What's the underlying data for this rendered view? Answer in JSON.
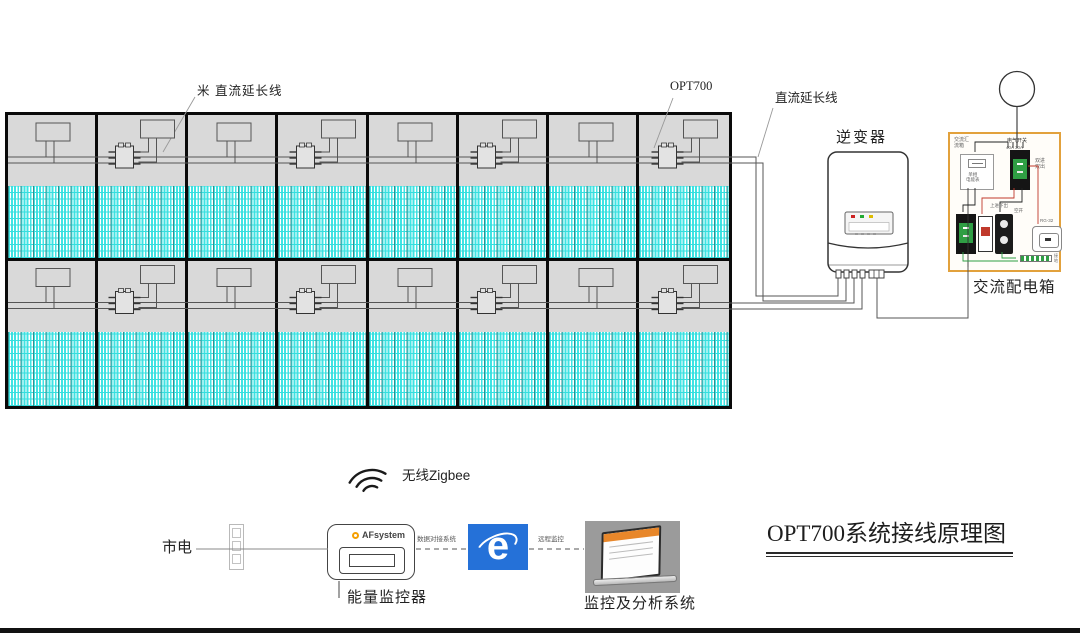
{
  "array": {
    "rows": 2,
    "cols": 8
  },
  "labels": {
    "dc_ext_top": "米  直流延长线",
    "opt700": "OPT700",
    "dc_ext_right": "直流延长线",
    "inverter": "逆变器",
    "inverter_brand": "Solis",
    "inverter_power": "5kW",
    "grid": "电网",
    "ac_box": "交流配电箱",
    "zigbee": "无线Zigbee",
    "mains": "市电",
    "monitor_brand": "AFsystem",
    "energy_monitor": "能量监控器",
    "link_monitor_ie": "数据对接系统",
    "link_ie_pc": "远程监控",
    "analysis_system": "监控及分析系统",
    "title": "OPT700系统接线原理图",
    "ie_letter": "e"
  },
  "ac_box_micro": {
    "corner": "交流汇\n流箱",
    "breaker_top_label": "电气开关",
    "breaker_top_rating": "40A  30A",
    "meter": "单相\n电能表",
    "dual_io": "双进\n双出",
    "cluster_label": "上进下出",
    "kong_kai": "空开",
    "socket_model": "RG-32",
    "ground": "接地"
  },
  "colors": {
    "panel_cell": "#3fe3e3",
    "panel_top": "#d9d9d9",
    "panel_frame": "#0a0a0a",
    "wire": "#555555",
    "accent_orange": "#e2a13c",
    "ie_blue": "#2571d8",
    "breaker_green": "#2f9e44",
    "led_red": "#cc2222",
    "led_green": "#22aa33",
    "led_yellow": "#ddbb00"
  }
}
